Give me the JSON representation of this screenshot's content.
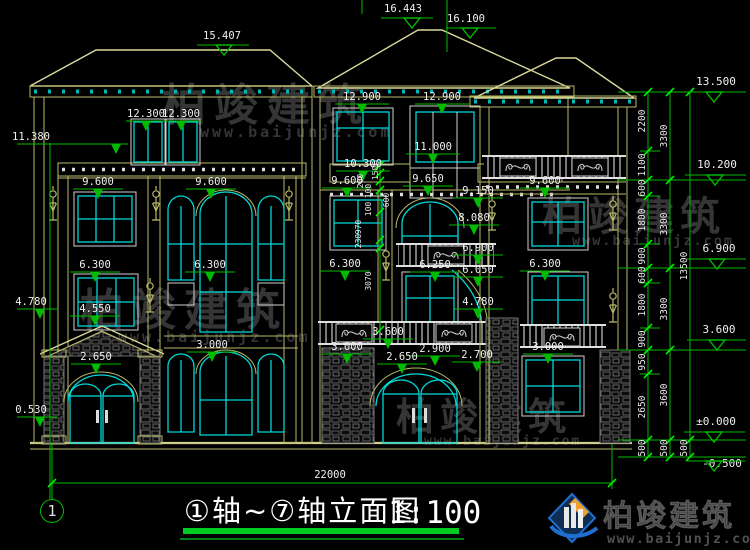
{
  "titleblock": {
    "axis_label": "①轴~⑦轴立面图",
    "scale": "1:100",
    "axis_bubble": "1"
  },
  "watermark": {
    "name": "柏竣建筑",
    "url": "www.baijunjz.com"
  },
  "brand": {
    "name": "柏竣建筑",
    "url": "www.baijunjz.com"
  },
  "elevation_marks": {
    "top": [
      "16.443",
      "16.100",
      "15.407"
    ],
    "facade": [
      "12.900",
      "12.900",
      "12.300",
      "12.300",
      "11.380",
      "11.000",
      "10.300",
      "9.600",
      "9.600",
      "9.600",
      "9.650",
      "9.600",
      "9.150",
      "8.080",
      "6.900",
      "6.300",
      "6.300",
      "6.300",
      "6.250",
      "6.050",
      "6.300",
      "4.780",
      "4.550",
      "4.780",
      "3.600",
      "3.000",
      "3.000",
      "2.900",
      "2.700",
      "3.000",
      "2.650",
      "2.650",
      "0.530"
    ],
    "right": [
      "13.500",
      "10.200",
      "6.900",
      "3.600",
      "±0.000",
      "-0.500"
    ]
  },
  "dim_chains": {
    "inner": [
      "200",
      "100",
      "150",
      "600",
      "100",
      "970",
      "230",
      "3070"
    ],
    "right_a": [
      "2200",
      "1100",
      "600",
      "1800",
      "900",
      "600",
      "1800",
      "900",
      "950",
      "2650",
      "500"
    ],
    "right_b": [
      "3300",
      "3300",
      "3300",
      "3600",
      "500"
    ],
    "right_c": [
      "13500",
      "500"
    ],
    "bottom_total": "22000"
  },
  "colors": {
    "background": "#000000",
    "outline": "#b9b96a",
    "window": "#00d8d8",
    "dimension": "#00bb00",
    "text": "#f0f0f0",
    "watermark": "#6a6a6a",
    "brand_blue": "#1e6fd0",
    "brand_orange": "#f09f2e"
  }
}
